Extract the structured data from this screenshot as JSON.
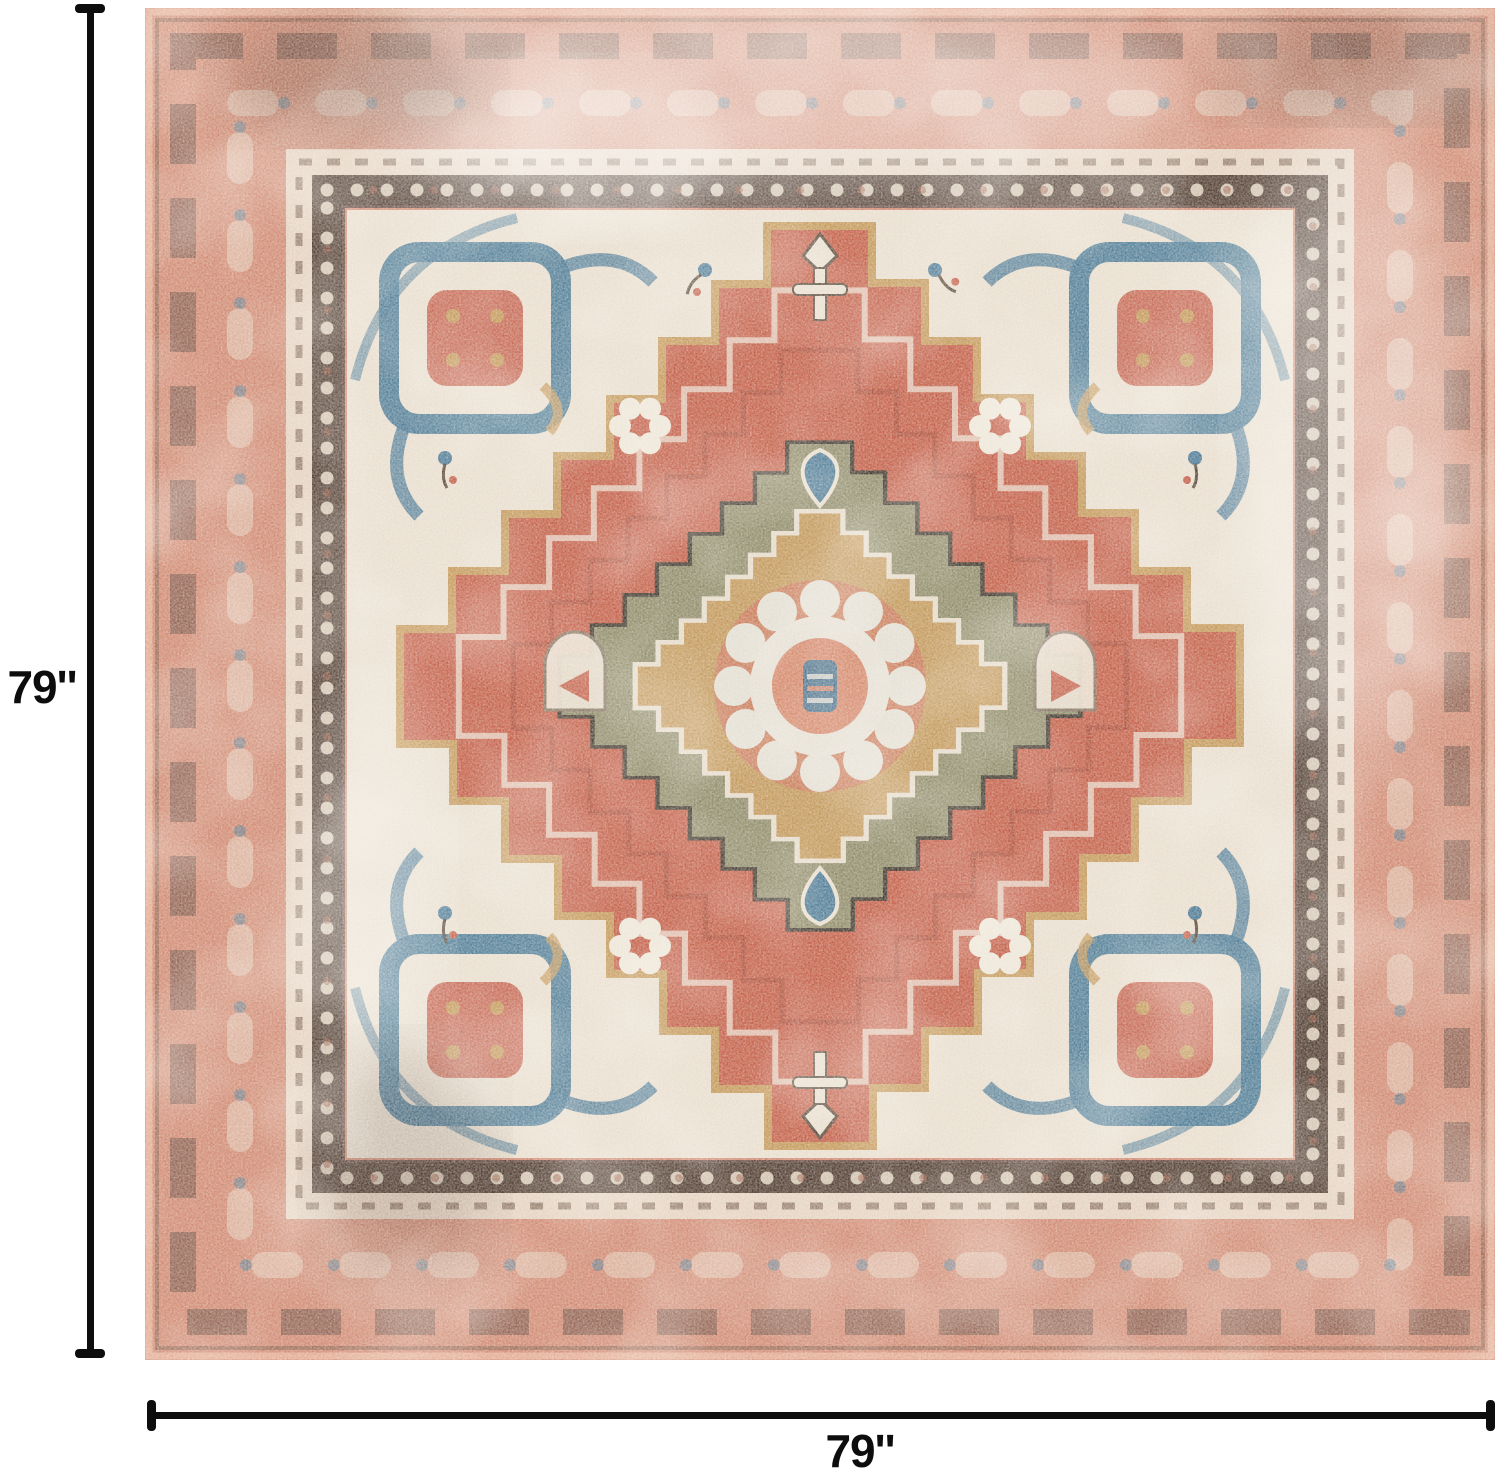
{
  "annotations": {
    "height_label": "79''",
    "width_label": "79''"
  },
  "image": {
    "alt": "Distressed vintage square area rug with stepped center medallion in terracotta, salmon, cream, steel blue, olive and gold"
  },
  "colors": {
    "page-bg": "#ffffff",
    "dim-line": "#0d0d0d",
    "label-text": "#0d0d0d",
    "rug-salmon": "#d18b74",
    "rug-salmon-light": "#e9b49c",
    "rug-terracotta": "#c4614b",
    "rug-cream": "#e9dfd0",
    "rug-steel-blue": "#4d7b97",
    "rug-olive": "#8e8f6e",
    "rug-gold": "#c59a5c",
    "rug-dark-brown": "#46382f"
  }
}
